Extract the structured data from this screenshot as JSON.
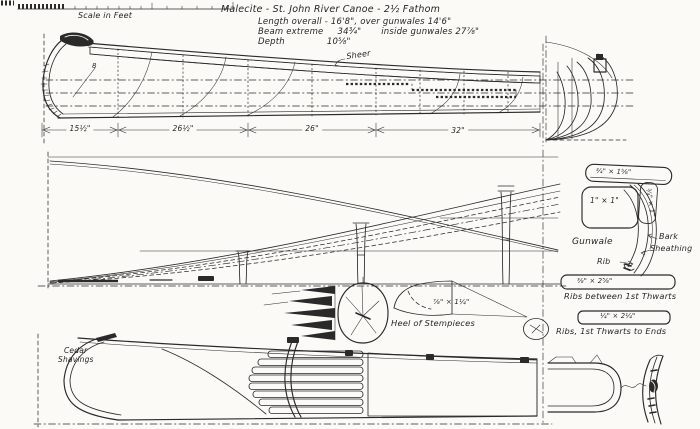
{
  "palette": {
    "ink": "#2a2a2a",
    "paper": "#fbfaf7"
  },
  "scale_bar": {
    "label": "Scale in Feet"
  },
  "title_block": {
    "title": "Malecite - St. John River Canoe - 2½ Fathom",
    "length_line": "Length overall - 16'8\",  over gunwales 14'6\"",
    "beam_label": "Beam extreme",
    "beam_value": "34¾\"",
    "beam_inside": "inside gunwales 27⅞\"",
    "depth_label": "Depth",
    "depth_value": "10⅝\""
  },
  "profile_view": {
    "sheer_label": "Sheer",
    "bow_station_label": "8",
    "dims": [
      "15½\"",
      "26½\"",
      "26\"",
      "32\""
    ]
  },
  "gunwale_detail": {
    "cap_dim": "¾\" × 1⅝\"",
    "inwale_dim": "1\" × 1\"",
    "outwale_dim": "¾\" × 1\"",
    "gunwale_label": "Gunwale",
    "bark_label": "Bark",
    "sheathing_label": "Sheathing",
    "rib_label": "Rib"
  },
  "rib_details": {
    "between_thwarts": {
      "dim": "⅜\" × 2⅝\"",
      "caption": "Ribs between 1st Thwarts"
    },
    "thwarts_to_ends": {
      "dim": "¼\" × 2¼\"",
      "caption": "Ribs, 1st Thwarts to Ends"
    }
  },
  "stempiece_detail": {
    "dim": "⅞\" × 1¼\"",
    "caption": "Heel of Stempieces"
  },
  "plan_view": {
    "material_label_line1": "Cedar",
    "material_label_line2": "Shavings"
  }
}
